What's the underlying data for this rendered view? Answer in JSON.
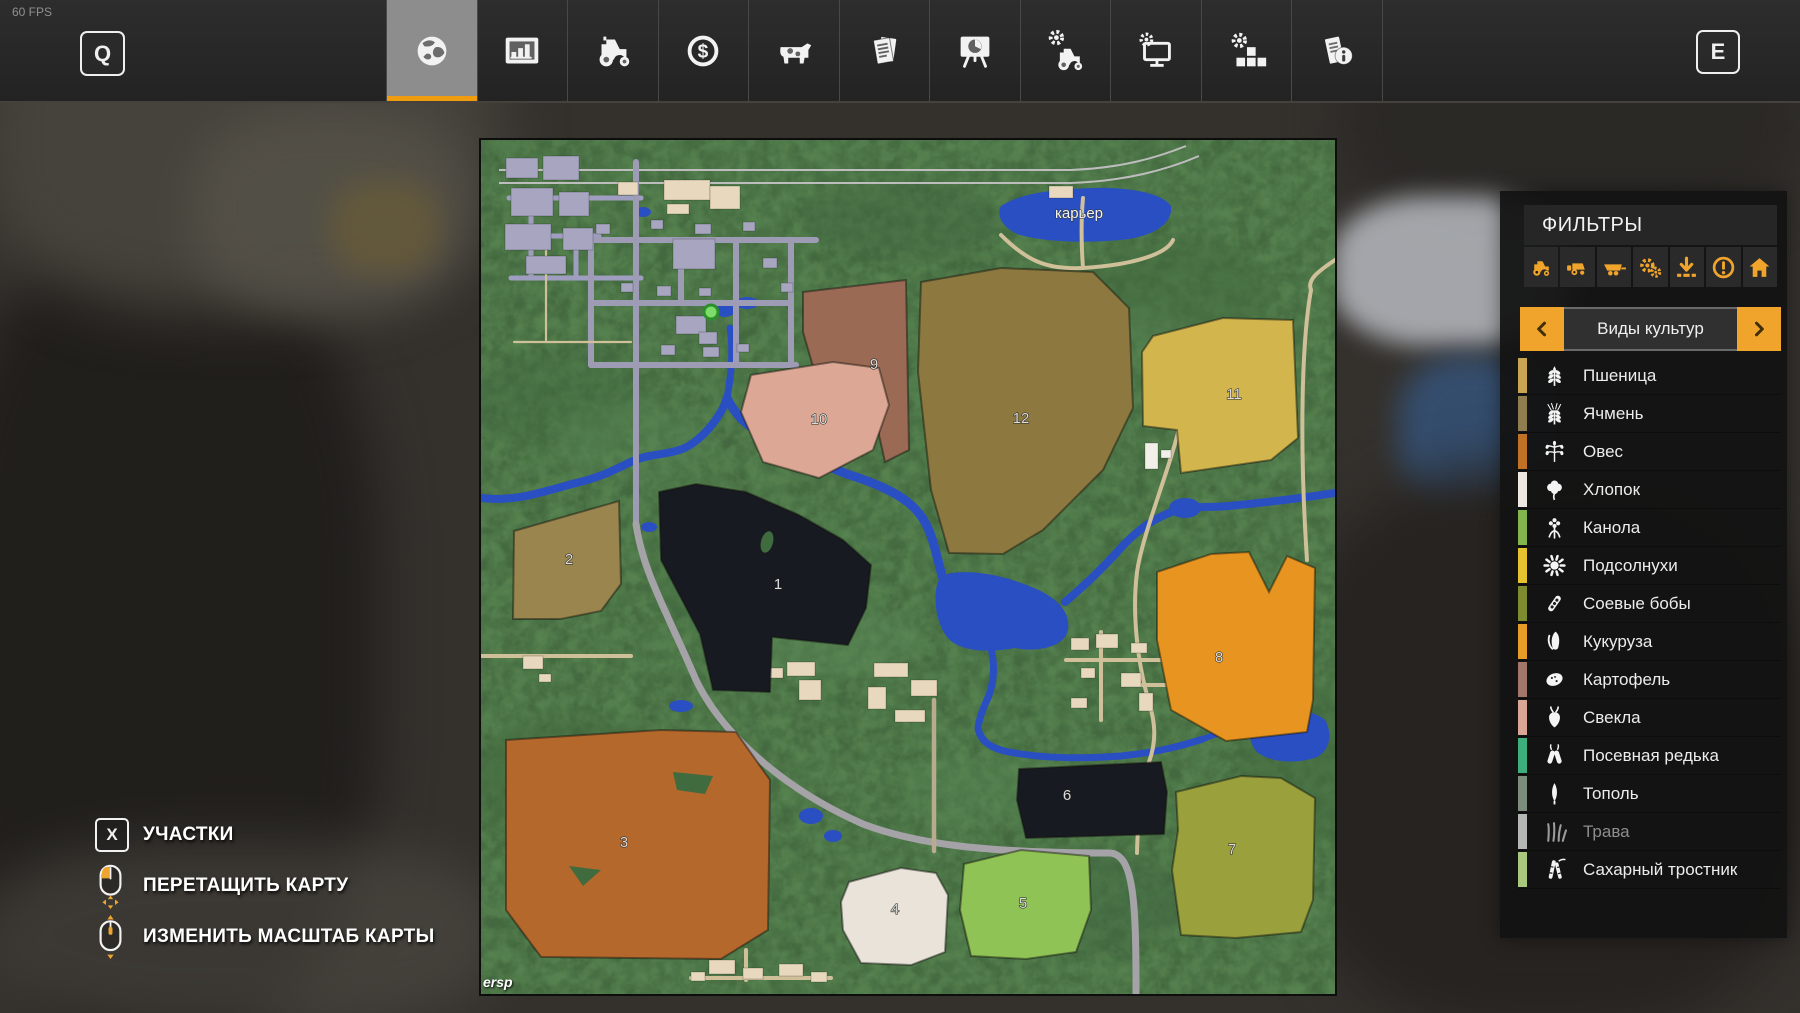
{
  "hud": {
    "fps": "60 FPS",
    "left_key": "Q",
    "right_key": "E"
  },
  "topbar": {
    "tabs": [
      {
        "icon": "globe",
        "selected": true
      },
      {
        "icon": "bar-chart",
        "selected": false
      },
      {
        "icon": "tractor",
        "selected": false
      },
      {
        "icon": "dollar",
        "selected": false
      },
      {
        "icon": "cow",
        "selected": false
      },
      {
        "icon": "documents",
        "selected": false
      },
      {
        "icon": "presentation",
        "selected": false
      },
      {
        "icon": "tractor-gear",
        "selected": false
      },
      {
        "icon": "monitor-gear",
        "selected": false
      },
      {
        "icon": "blocks-gear",
        "selected": false
      },
      {
        "icon": "info-document",
        "selected": false
      }
    ]
  },
  "filters": {
    "title": "ФИЛЬТРЫ",
    "accent_color": "#f0a42c",
    "icons": [
      "tractor",
      "harvester",
      "trailer",
      "gears",
      "download",
      "attention",
      "home"
    ],
    "selector": {
      "label": "Виды культур"
    },
    "crops": [
      {
        "label": "Пшеница",
        "icon": "wheat",
        "color": "#c9a452",
        "enabled": true
      },
      {
        "label": "Ячмень",
        "icon": "barley",
        "color": "#8f7d4f",
        "enabled": true
      },
      {
        "label": "Овес",
        "icon": "oats",
        "color": "#bf7226",
        "enabled": true
      },
      {
        "label": "Хлопок",
        "icon": "cotton",
        "color": "#ece8e1",
        "enabled": true
      },
      {
        "label": "Канола",
        "icon": "canola",
        "color": "#83b54e",
        "enabled": true
      },
      {
        "label": "Подсолнухи",
        "icon": "sunflower",
        "color": "#e5c32f",
        "enabled": true
      },
      {
        "label": "Соевые бобы",
        "icon": "soybean",
        "color": "#7e8c2f",
        "enabled": true
      },
      {
        "label": "Кукуруза",
        "icon": "corn",
        "color": "#e59d25",
        "enabled": true
      },
      {
        "label": "Картофель",
        "icon": "potato",
        "color": "#a3766a",
        "enabled": true
      },
      {
        "label": "Свекла",
        "icon": "beet",
        "color": "#d9a695",
        "enabled": true
      },
      {
        "label": "Посевная редька",
        "icon": "radish",
        "color": "#3fae7d",
        "enabled": true
      },
      {
        "label": "Тополь",
        "icon": "poplar",
        "color": "#7d8d7c",
        "enabled": true
      },
      {
        "label": "Трава",
        "icon": "grass",
        "color": "#b4b8b4",
        "enabled": false
      },
      {
        "label": "Сахарный тростник",
        "icon": "sugarcane",
        "color": "#a9c77d",
        "enabled": true
      }
    ]
  },
  "legend": [
    {
      "type": "key",
      "key": "X",
      "label": "УЧАСТКИ"
    },
    {
      "type": "mouse-drag",
      "label": "ПЕРЕТАЩИТЬ КАРТУ"
    },
    {
      "type": "mouse-scroll",
      "label": "ИЗМЕНИТЬ МАСШТАБ КАРТЫ"
    }
  ],
  "map": {
    "watermark": "ersp",
    "quarry_label": "карьер",
    "fields": [
      {
        "n": "1",
        "color": "#181a21",
        "x": 297,
        "y": 449,
        "pts": "178,352 215,344 265,352 318,375 362,400 390,425 385,468 367,505 291,497 289,552 232,550 219,494 180,420"
      },
      {
        "n": "2",
        "color": "#99854d",
        "x": 88,
        "y": 424,
        "pts": "33,391 138,361 140,444 120,471 80,479 32,479"
      },
      {
        "n": "3",
        "color": "#b5682c",
        "x": 143,
        "y": 707,
        "pts": "25,600 180,590 255,592 289,640 287,790 240,819 60,817 25,770"
      },
      {
        "n": "4",
        "color": "#e9e3da",
        "x": 414,
        "y": 774,
        "pts": "368,742 420,728 455,733 467,755 464,812 430,825 380,823 362,790 360,762"
      },
      {
        "n": "5",
        "color": "#90c355",
        "x": 542,
        "y": 768,
        "pts": "483,724 540,710 608,716 610,770 595,812 545,819 490,816 479,770"
      },
      {
        "n": "6",
        "color": "#181a21",
        "x": 586,
        "y": 660,
        "pts": "538,629 680,622 686,652 683,694 545,698 536,660"
      },
      {
        "n": "7",
        "color": "#99a03c",
        "x": 751,
        "y": 714,
        "pts": "695,652 760,636 800,638 834,658 832,760 820,792 755,798 700,795 691,730 697,690"
      },
      {
        "n": "8",
        "color": "#e79420",
        "x": 738,
        "y": 522,
        "pts": "676,432 730,414 768,412 788,452 806,416 834,428 832,560 826,592 745,601 690,570 676,500"
      },
      {
        "n": "9",
        "color": "#9b6a54",
        "x": 393,
        "y": 229,
        "pts": "322,152 425,140 428,310 404,322 398,295 400,240 335,237 322,192"
      },
      {
        "n": "10",
        "color": "#dca794",
        "x": 338,
        "y": 284,
        "pts": "270,235 352,222 398,228 408,265 392,310 338,338 282,322 260,272"
      },
      {
        "n": "11",
        "color": "#d2b54d",
        "x": 753,
        "y": 259,
        "pts": "672,196 742,178 812,180 817,298 790,320 700,333 696,290 662,286 661,212"
      },
      {
        "n": "12",
        "color": "#8d793f",
        "x": 540,
        "y": 283,
        "pts": "440,142 520,128 612,132 648,168 652,268 622,330 562,390 522,414 468,413 450,350 437,232"
      }
    ]
  }
}
